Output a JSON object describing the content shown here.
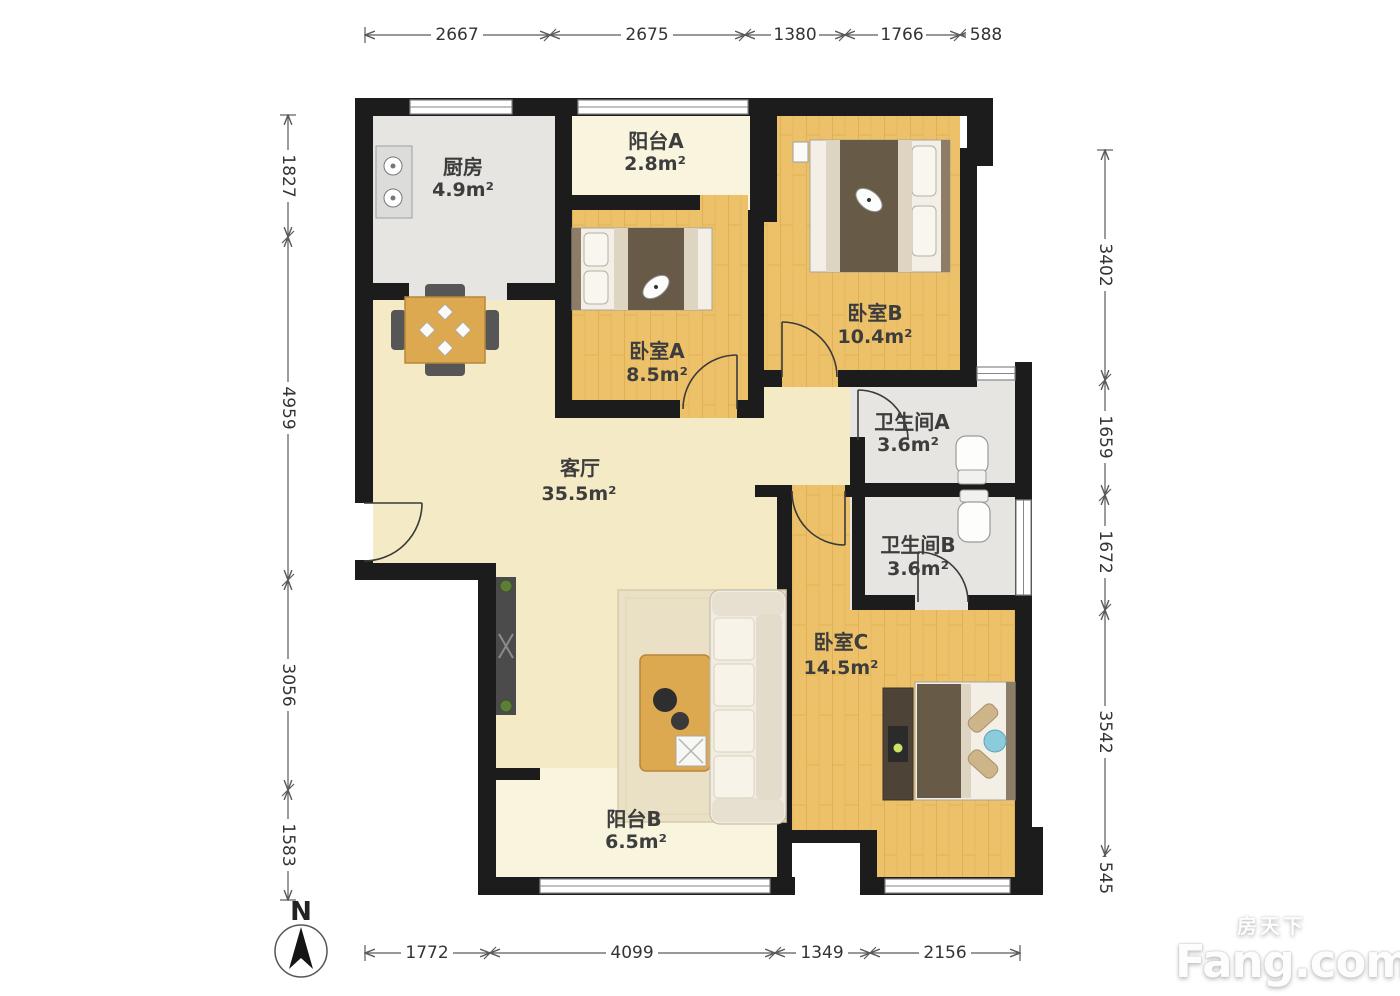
{
  "plan": {
    "rooms": {
      "kitchen": {
        "name": "厨房",
        "area": "4.9m²"
      },
      "balcony_a": {
        "name": "阳台A",
        "area": "2.8m²"
      },
      "bedroom_a": {
        "name": "卧室A",
        "area": "8.5m²"
      },
      "bedroom_b": {
        "name": "卧室B",
        "area": "10.4m²"
      },
      "bathroom_a": {
        "name": "卫生间A",
        "area": "3.6m²"
      },
      "bathroom_b": {
        "name": "卫生间B",
        "area": "3.6m²"
      },
      "living": {
        "name": "客厅",
        "area": "35.5m²"
      },
      "bedroom_c": {
        "name": "卧室C",
        "area": "14.5m²"
      },
      "balcony_b": {
        "name": "阳台B",
        "area": "6.5m²"
      }
    },
    "dims": {
      "top": [
        "2667",
        "2675",
        "1380",
        "1766",
        "588"
      ],
      "left": [
        "1827",
        "4959",
        "3056",
        "1583"
      ],
      "right": [
        "3402",
        "1659",
        "1672",
        "3542",
        "545"
      ],
      "bottom": [
        "1772",
        "4099",
        "1349",
        "2156"
      ]
    },
    "compass": {
      "label": "N"
    },
    "watermark": {
      "cn": "房天下",
      "en": "Fang.com"
    },
    "colors": {
      "wall": "#1c1c1c",
      "wood_floor": "#ecc169",
      "living_floor": "#f4eac6",
      "balcony_floor": "#f8f4de",
      "tile_floor": "#e7e5e1"
    }
  }
}
